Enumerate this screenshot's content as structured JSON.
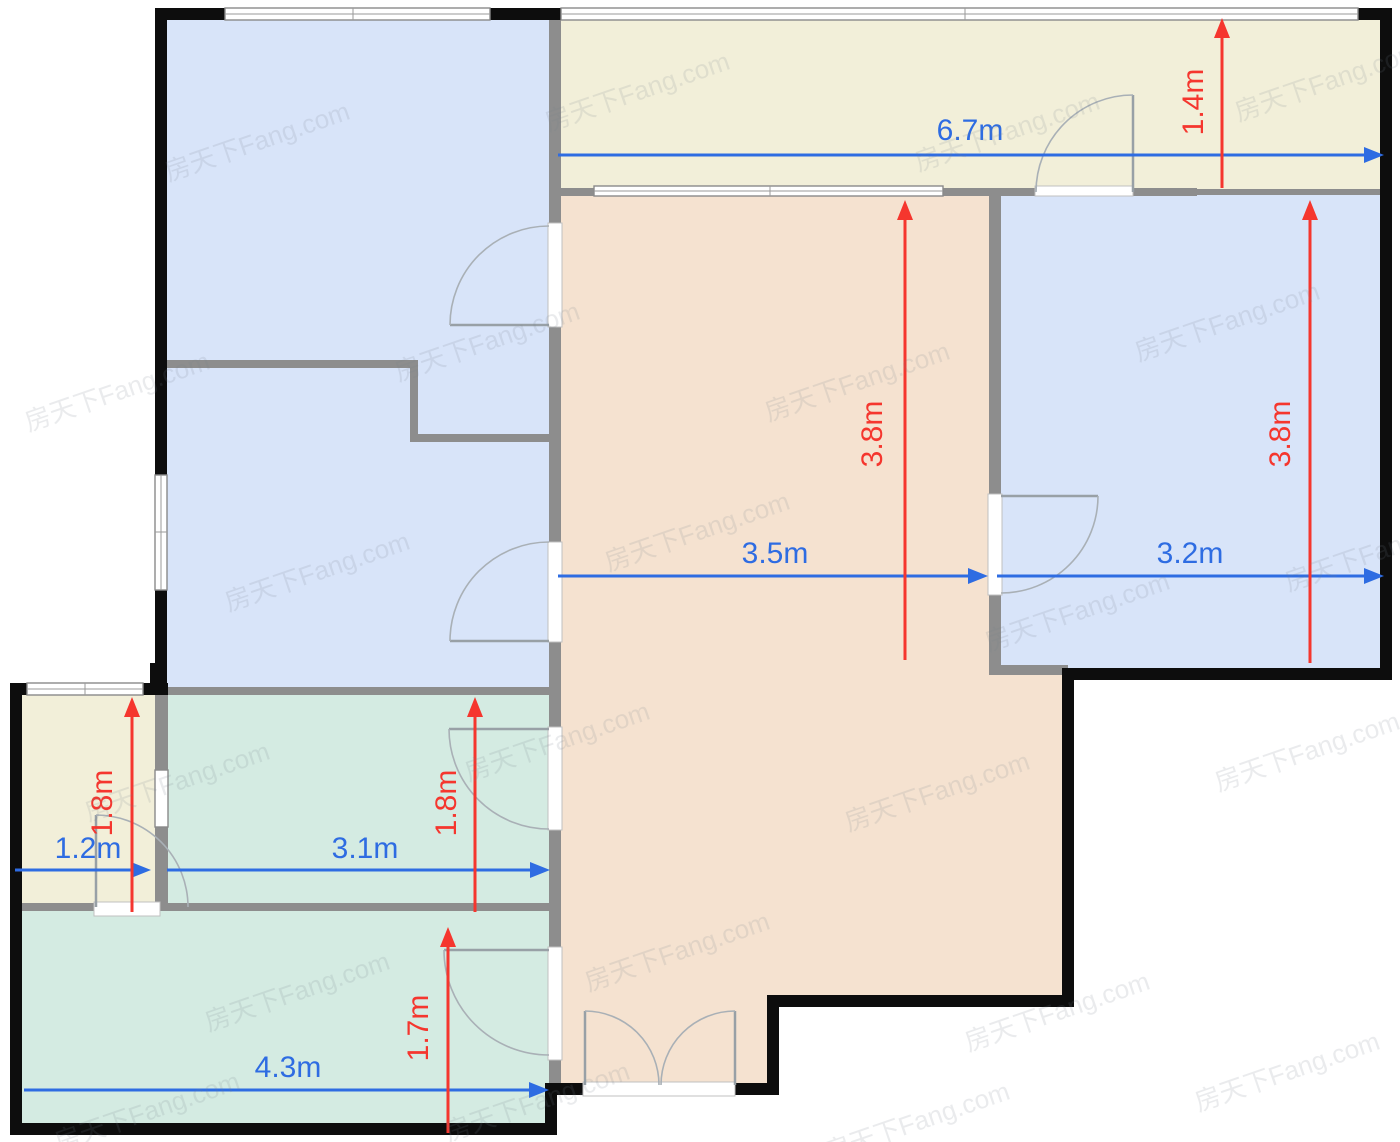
{
  "watermark": {
    "text": "房天下Fang.com"
  },
  "colors": {
    "room_blue": "#d8e4f9",
    "room_cream": "#f2efd9",
    "room_pink": "#f5e2d0",
    "room_teal": "#d4ebe2",
    "dim_blue": "#2e6ce2",
    "dim_red": "#f5362e",
    "wall_black": "#0d0d0d",
    "wall_gray": "#8d8d8d"
  },
  "dimensions": {
    "balcony_width": "6.7m",
    "balcony_depth": "1.4m",
    "living_width": "3.5m",
    "living_height": "3.8m",
    "bedroom_right_width": "3.2m",
    "bedroom_right_height": "3.8m",
    "bath_width": "1.2m",
    "bath_height": "1.8m",
    "mid_room_width": "3.1m",
    "mid_room_height": "1.8m",
    "bottom_room_width": "4.3m",
    "bottom_room_height": "1.7m"
  }
}
